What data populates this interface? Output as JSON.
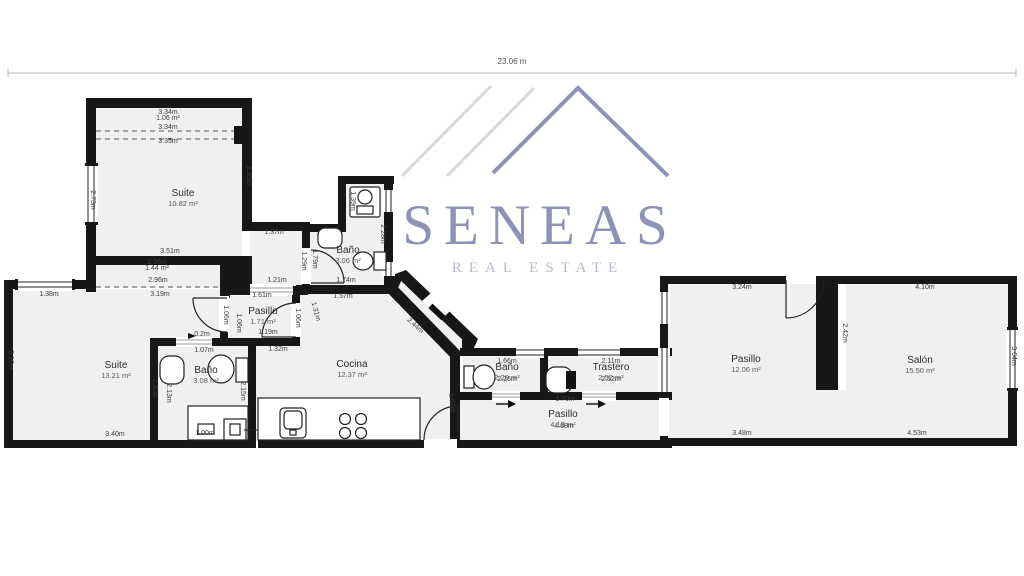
{
  "logo": {
    "name": "SENEAS",
    "tagline": "REAL ESTATE",
    "accent_color": "#8d93b7",
    "tagline_color": "#b7bbce"
  },
  "plan": {
    "overall_width": "23.06 m",
    "rooms": [
      {
        "id": "suite-top",
        "name": "Suite",
        "area": "10.82 m²",
        "x": 183,
        "y": 196
      },
      {
        "id": "suite-left",
        "name": "Suite",
        "area": "13.21 m²",
        "x": 116,
        "y": 368
      },
      {
        "id": "bano-top",
        "name": "Baño",
        "area": "3.06 m²",
        "x": 348,
        "y": 253
      },
      {
        "id": "bano-left",
        "name": "Baño",
        "area": "3.08 m²",
        "x": 206,
        "y": 373
      },
      {
        "id": "pasillo-small",
        "name": "Pasillo",
        "area": "1.71 m²",
        "x": 263,
        "y": 314
      },
      {
        "id": "cocina",
        "name": "Cocina",
        "area": "12.37 m²",
        "x": 352,
        "y": 367
      },
      {
        "id": "bano-center",
        "name": "Baño",
        "area": "2.20 m²",
        "x": 507,
        "y": 370
      },
      {
        "id": "trastero",
        "name": "Trastero",
        "area": "2.52 m²",
        "x": 611,
        "y": 370
      },
      {
        "id": "pasillo-bottom",
        "name": "Pasillo",
        "area": "4.13 m²",
        "x": 563,
        "y": 417
      },
      {
        "id": "pasillo-right",
        "name": "Pasillo",
        "area": "12.06 m²",
        "x": 746,
        "y": 362
      },
      {
        "id": "salon",
        "name": "Salón",
        "area": "15.50 m²",
        "x": 920,
        "y": 363
      }
    ],
    "measurements": [
      {
        "t": "3.34m",
        "x": 168,
        "y": 114,
        "r": 0
      },
      {
        "t": "1.06 m²",
        "x": 168,
        "y": 120,
        "r": 0
      },
      {
        "t": "3.34m",
        "x": 168,
        "y": 129,
        "r": 0
      },
      {
        "t": "3.35m",
        "x": 168,
        "y": 143,
        "r": 0
      },
      {
        "t": "2.65m",
        "x": 247,
        "y": 176,
        "r": 90
      },
      {
        "t": "2.73m",
        "x": 91,
        "y": 200,
        "r": 90
      },
      {
        "t": "3.51m",
        "x": 170,
        "y": 253,
        "r": 0
      },
      {
        "t": "2.96m",
        "x": 157,
        "y": 264,
        "r": 0
      },
      {
        "t": "1.44 m²",
        "x": 157,
        "y": 270,
        "r": 0
      },
      {
        "t": "2.96m",
        "x": 158,
        "y": 282,
        "r": 0
      },
      {
        "t": "3.19m",
        "x": 160,
        "y": 296,
        "r": 0
      },
      {
        "t": "1.38m",
        "x": 49,
        "y": 296,
        "r": 0
      },
      {
        "t": "3.16m",
        "x": 9,
        "y": 360,
        "r": 90
      },
      {
        "t": "3.40m",
        "x": 115,
        "y": 436,
        "r": 0
      },
      {
        "t": "2.30m",
        "x": 153,
        "y": 388,
        "r": 90
      },
      {
        "t": "0.2m",
        "x": 202,
        "y": 336,
        "r": 0
      },
      {
        "t": "1.07m",
        "x": 204,
        "y": 352,
        "r": 0
      },
      {
        "t": "2.13m",
        "x": 167,
        "y": 393,
        "r": 90
      },
      {
        "t": "2.15m",
        "x": 241,
        "y": 391,
        "r": 90
      },
      {
        "t": "1.00m",
        "x": 205,
        "y": 435,
        "r": 0
      },
      {
        "t": "1.61m",
        "x": 262,
        "y": 297,
        "r": 0
      },
      {
        "t": "1.06m",
        "x": 224,
        "y": 315,
        "r": 90
      },
      {
        "t": "1.06m",
        "x": 237,
        "y": 323,
        "r": 90
      },
      {
        "t": "1.06m",
        "x": 296,
        "y": 318,
        "r": 90
      },
      {
        "t": "1.19m",
        "x": 268,
        "y": 334,
        "r": 0
      },
      {
        "t": "1.31m",
        "x": 314,
        "y": 312,
        "r": 75
      },
      {
        "t": "1.37m",
        "x": 274,
        "y": 234,
        "r": 0
      },
      {
        "t": "1.29m",
        "x": 302,
        "y": 261,
        "r": 90
      },
      {
        "t": "1.79m",
        "x": 313,
        "y": 259,
        "r": 90
      },
      {
        "t": "1.21m",
        "x": 277,
        "y": 282,
        "r": 0
      },
      {
        "t": "1.74m",
        "x": 346,
        "y": 282,
        "r": 0
      },
      {
        "t": "1.39m",
        "x": 351,
        "y": 201,
        "r": 90
      },
      {
        "t": "2.28m",
        "x": 381,
        "y": 234,
        "r": 90
      },
      {
        "t": "1.57m",
        "x": 343,
        "y": 298,
        "r": 0
      },
      {
        "t": "1.32m",
        "x": 278,
        "y": 351,
        "r": 0
      },
      {
        "t": "2.44m",
        "x": 414,
        "y": 327,
        "r": 43
      },
      {
        "t": "1.67m",
        "x": 450,
        "y": 403,
        "r": 85
      },
      {
        "t": "1.66m",
        "x": 507,
        "y": 363,
        "r": 0
      },
      {
        "t": "2.26m",
        "x": 507,
        "y": 381,
        "r": 0
      },
      {
        "t": "2.11m",
        "x": 611,
        "y": 363,
        "r": 0
      },
      {
        "t": "2.52m",
        "x": 611,
        "y": 381,
        "r": 0
      },
      {
        "t": "1.70m",
        "x": 565,
        "y": 401,
        "r": 0
      },
      {
        "t": "4.68m",
        "x": 564,
        "y": 428,
        "r": 0
      },
      {
        "t": "3.24m",
        "x": 742,
        "y": 289,
        "r": 0
      },
      {
        "t": "3.48m",
        "x": 742,
        "y": 435,
        "r": 0
      },
      {
        "t": "4.10m",
        "x": 925,
        "y": 289,
        "r": 0
      },
      {
        "t": "4.53m",
        "x": 917,
        "y": 435,
        "r": 0
      },
      {
        "t": "2.42m",
        "x": 843,
        "y": 333,
        "r": 90
      },
      {
        "t": "3.64m",
        "x": 1012,
        "y": 356,
        "r": 90
      }
    ]
  }
}
